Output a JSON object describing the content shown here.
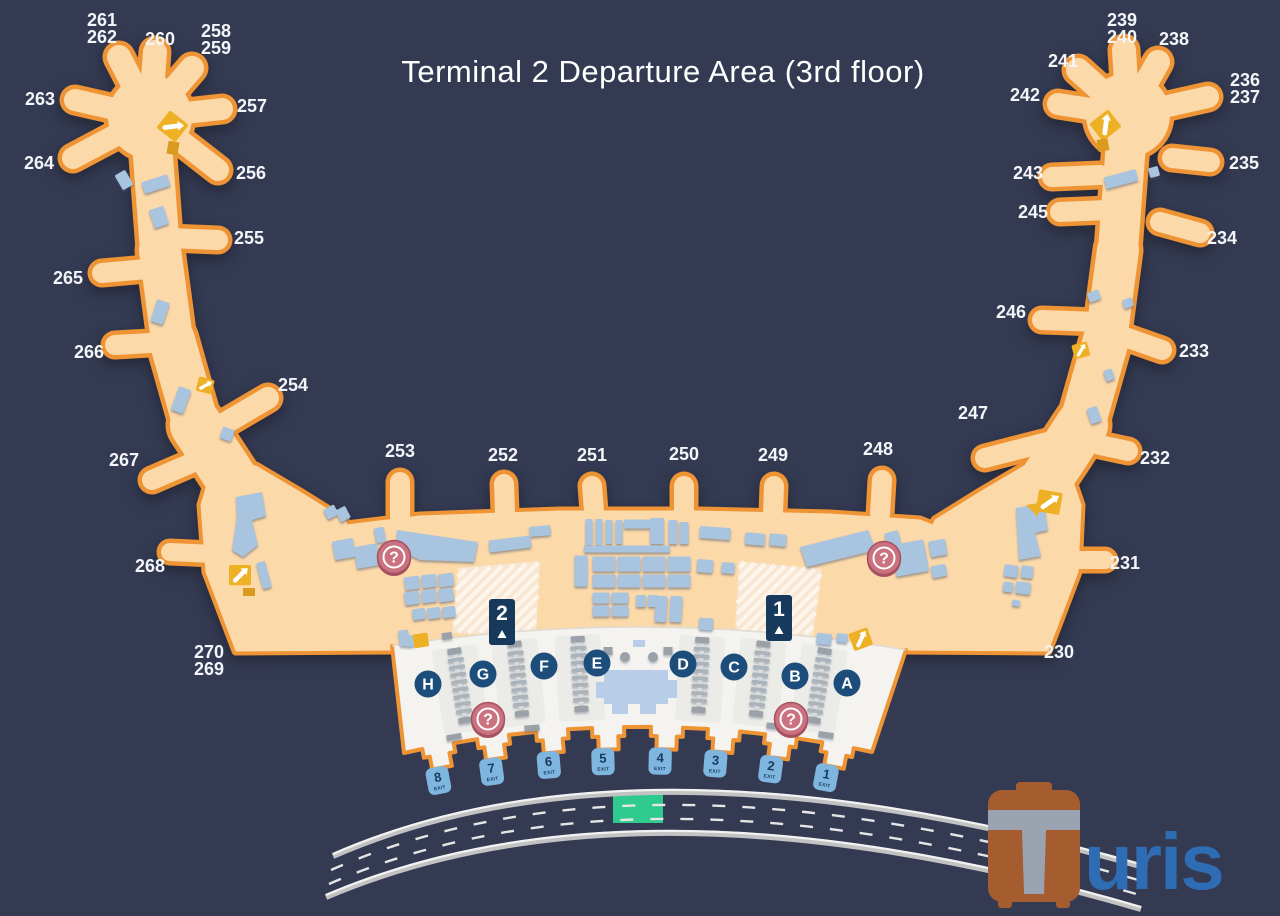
{
  "title": "Terminal 2 Departure Area (3rd floor)",
  "map": {
    "gates": [
      "261",
      "262",
      "260",
      "258",
      "259",
      "263",
      "257",
      "264",
      "256",
      "255",
      "265",
      "266",
      "254",
      "267",
      "268",
      "270",
      "269",
      "253",
      "252",
      "251",
      "250",
      "249",
      "248",
      "239",
      "240",
      "238",
      "241",
      "236",
      "237",
      "242",
      "243",
      "245",
      "235",
      "234",
      "246",
      "233",
      "247",
      "232",
      "231",
      "230"
    ],
    "checkin_islands": [
      "H",
      "G",
      "F",
      "E",
      "D",
      "C",
      "B",
      "A"
    ],
    "exits": {
      "door_numbers": [
        "8",
        "7",
        "6",
        "5",
        "4",
        "3",
        "2",
        "1"
      ],
      "label": "EXIT"
    },
    "entrance_markers": [
      "2",
      "1"
    ],
    "info_points": {
      "symbol": "?",
      "count": 4
    }
  },
  "logo": {
    "brand": "Turis",
    "suffix": "uris"
  },
  "colors": {
    "background": "#343a52",
    "terminal_fill": "#fcd9a9",
    "terminal_stroke": "#ef9435",
    "hall_fill": "#f4f3f0",
    "island_fill": "#ebebe7",
    "shop_fill": "#a9c4df",
    "structure_fill": "#b8cee8",
    "counter_fill": "#abb3bb",
    "counter_spine": "#d8dbde",
    "gray_item": "#9aa1a8",
    "info_fill": "#ca7280",
    "info_ring": "#a5515f",
    "gold": "#eeb024",
    "gold_dark": "#d99a1e",
    "letter_circle": "#1d4d7b",
    "exit_fill": "#7fb6df",
    "exit_text": "#173a5e",
    "marker_fill": "#16395c",
    "road_line": "#c2c2c2",
    "road_highlight": "#f2f2f2",
    "road_dash": "#e6e6e6",
    "green_zone": "#2fca8e",
    "hatch_base": "#f8e5d2",
    "hatch_stripe": "#fef5ea",
    "logo_brown": "#a55c2e",
    "logo_gray": "#9ba3b0",
    "logo_blue": "#2e6cb4"
  }
}
